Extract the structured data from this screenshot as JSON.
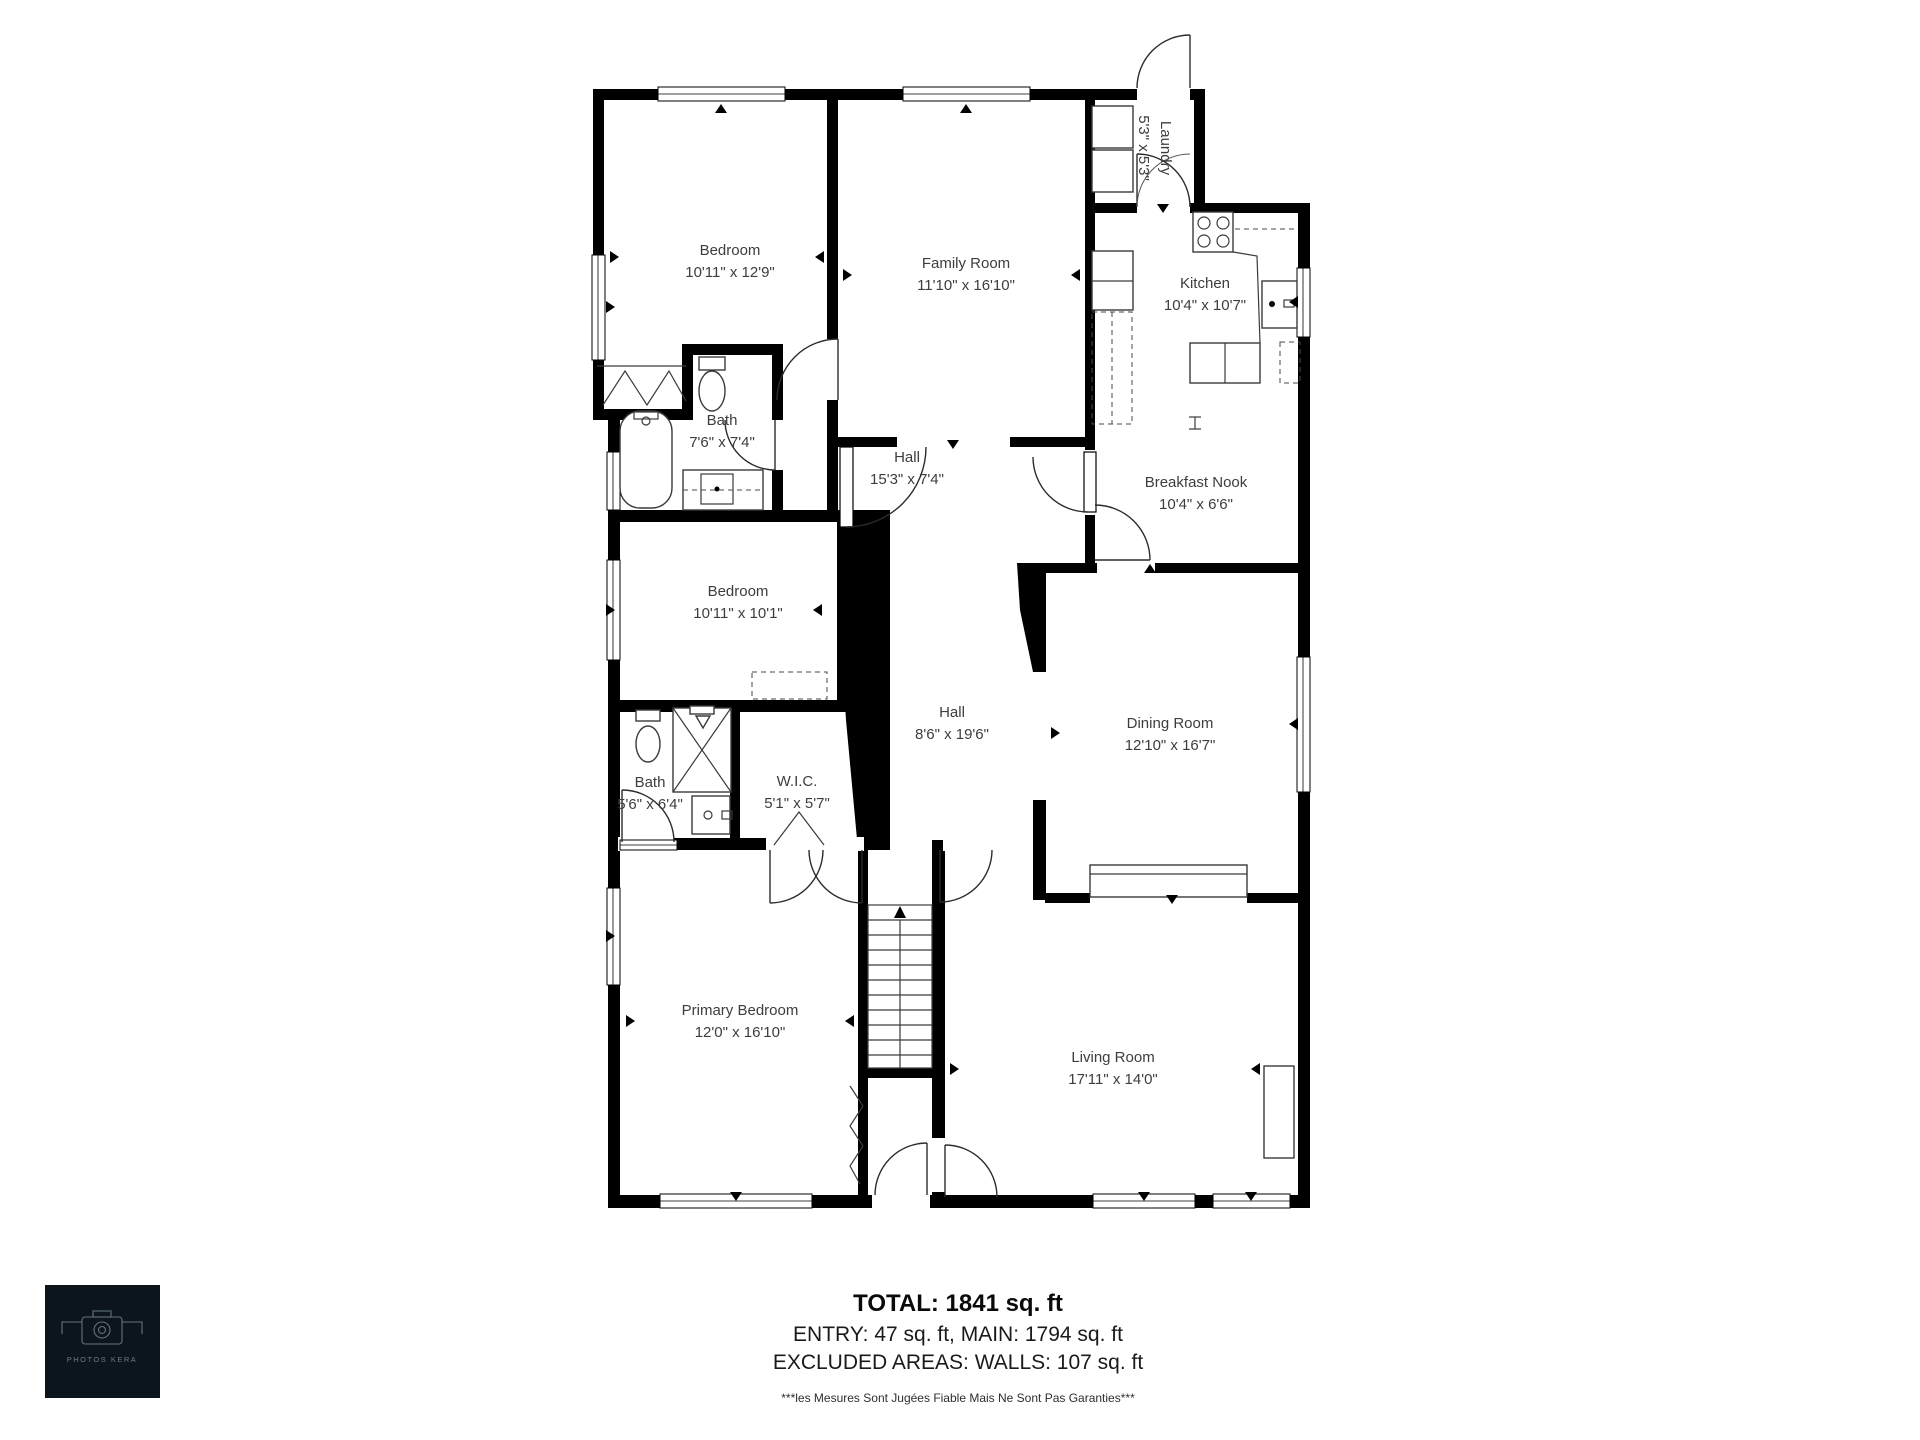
{
  "rooms": [
    {
      "id": "bedroom-1",
      "name": "Bedroom",
      "dims": "10'11\" x 12'9\""
    },
    {
      "id": "family-room",
      "name": "Family Room",
      "dims": "11'10\" x 16'10\""
    },
    {
      "id": "laundry",
      "name": "Laundry",
      "dims": "5'3\" x 5'3\""
    },
    {
      "id": "kitchen",
      "name": "Kitchen",
      "dims": "10'4\" x 10'7\""
    },
    {
      "id": "bath-upper",
      "name": "Bath",
      "dims": "7'6\" x 7'4\""
    },
    {
      "id": "hall-upper",
      "name": "Hall",
      "dims": "15'3\" x 7'4\""
    },
    {
      "id": "breakfast-nook",
      "name": "Breakfast Nook",
      "dims": "10'4\" x 6'6\""
    },
    {
      "id": "bedroom-2",
      "name": "Bedroom",
      "dims": "10'11\" x 10'1\""
    },
    {
      "id": "bath-lower",
      "name": "Bath",
      "dims": "5'6\" x 6'4\""
    },
    {
      "id": "wic",
      "name": "W.I.C.",
      "dims": "5'1\" x 5'7\""
    },
    {
      "id": "hall-lower",
      "name": "Hall",
      "dims": "8'6\" x 19'6\""
    },
    {
      "id": "dining-room",
      "name": "Dining Room",
      "dims": "12'10\" x 16'7\""
    },
    {
      "id": "primary-bedroom",
      "name": "Primary Bedroom",
      "dims": "12'0\" x 16'10\""
    },
    {
      "id": "living-room",
      "name": "Living Room",
      "dims": "17'11\" x 14'0\""
    }
  ],
  "summary": {
    "total": "TOTAL: 1841 sq. ft",
    "breakdown": "ENTRY: 47 sq. ft, MAIN: 1794 sq. ft",
    "excluded": "EXCLUDED AREAS: WALLS: 107 sq. ft"
  },
  "disclaimer": "***les Mesures Sont Jugées Fiable Mais Ne Sont Pas Garanties***",
  "logo": {
    "brand": "PHOTOS KERA"
  },
  "colors": {
    "wall": "#000000",
    "paper": "#ffffff",
    "logo_bg": "#0c151b",
    "logo_fg": "#6b7a82"
  }
}
